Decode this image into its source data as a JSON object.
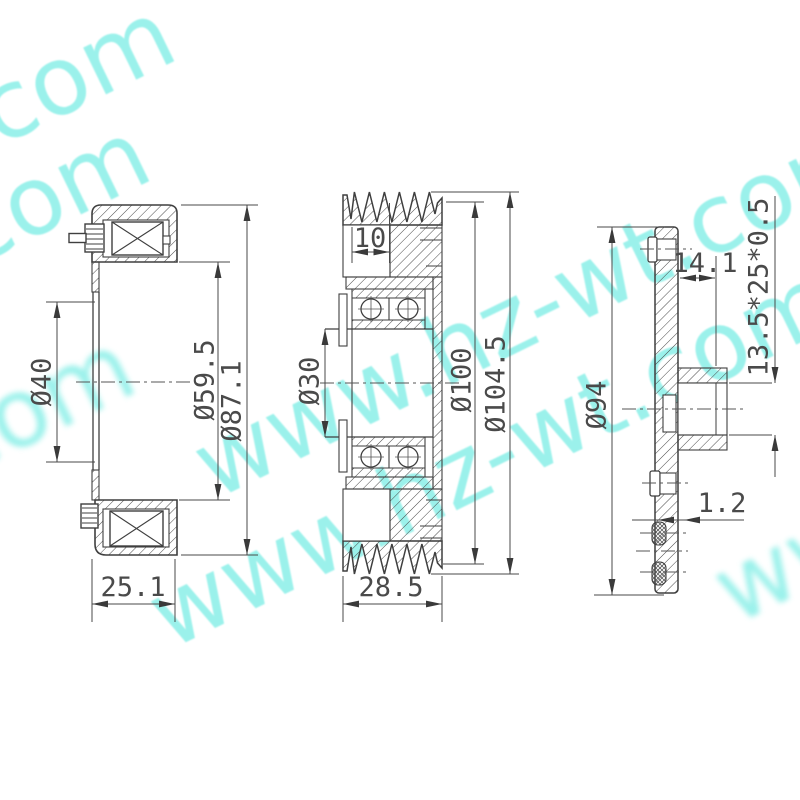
{
  "watermark": {
    "text": "www.hz-wt.com",
    "color": "#82eee6"
  },
  "drawing": {
    "line_color": "#3f3f3f",
    "dim_color": "#4a4a4a"
  },
  "views": [
    {
      "id": "field-coil-section",
      "dims": {
        "d40": "Ø40",
        "d59_5": "Ø59.5",
        "d87_1": "Ø87.1",
        "w25_1": "25.1"
      }
    },
    {
      "id": "pulley-section",
      "dims": {
        "w10": "10",
        "d30": "Ø30",
        "d100": "Ø100",
        "d104_5": "Ø104.5",
        "w28_5": "28.5"
      }
    },
    {
      "id": "hub-plate-section",
      "dims": {
        "w14_1": "14.1",
        "bearing_spec": "13.5*25*0.5",
        "d94": "Ø94",
        "t1_2": "1.2"
      }
    }
  ]
}
